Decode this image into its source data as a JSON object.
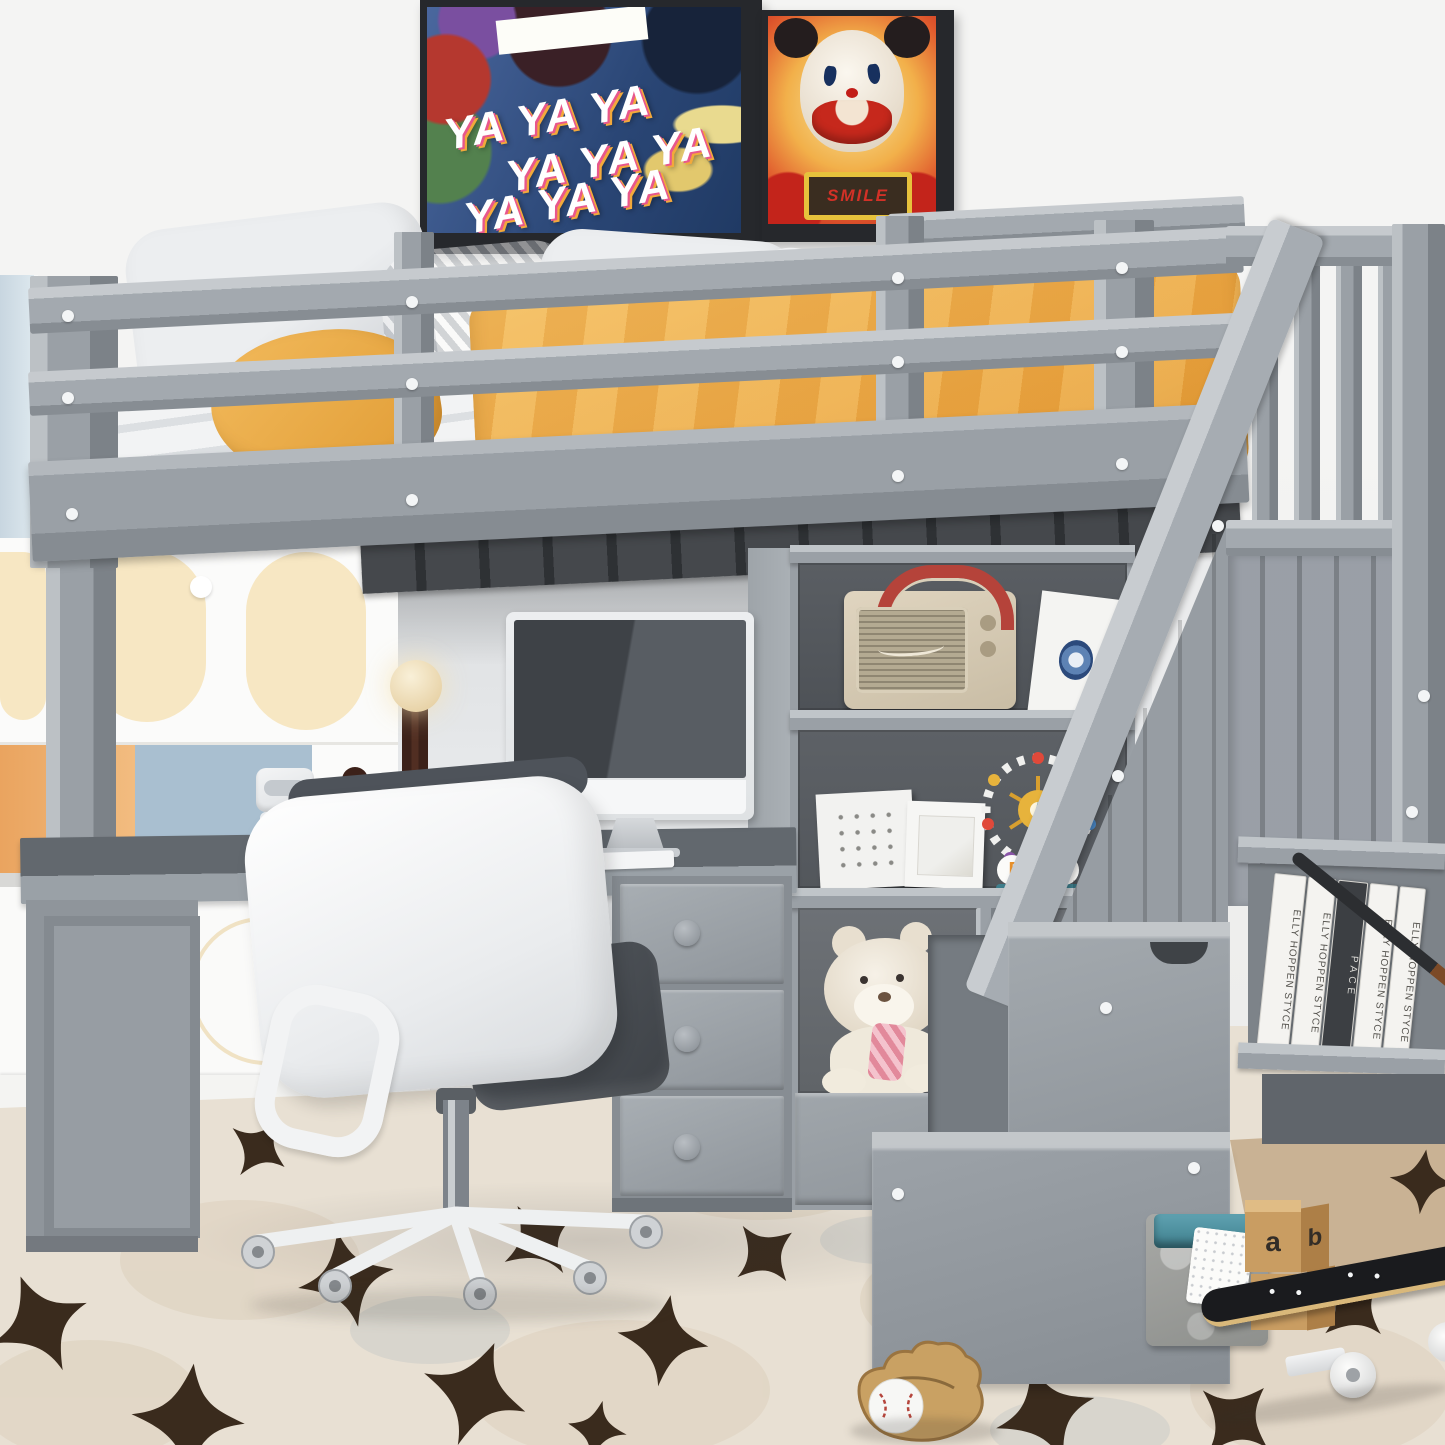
{
  "scene": {
    "name": "kids-room-gray-loft-bed-with-desk-stairs-product-photo"
  },
  "posters": {
    "ya": {
      "lines": [
        "YA YA YA",
        "YA YA YA",
        "YA YA YA"
      ]
    },
    "smile": {
      "sign": "SMILE"
    }
  },
  "lego": {
    "sign": "FUN"
  },
  "books": {
    "spines": [
      "ELLY HOPPEN STYCE",
      "ELLY HOPPEN STYCE",
      "PACE",
      "ELLY HOPPEN STYCE",
      "ELLY HOPPEN STYCE"
    ]
  },
  "blocks": {
    "faces": [
      "a",
      "b",
      "3",
      "4"
    ]
  },
  "palette": {
    "furniture_gray": "#9aa0a6",
    "furniture_gray_light": "#c3c7cb",
    "furniture_gray_dark": "#6e747a",
    "shelf_back": "#54585d",
    "blanket_yellow": "#efae45",
    "wall": "#f1f1f0",
    "rug_cream": "#e8e0d3",
    "rug_spot_brown": "#3a2b1d",
    "radio_cream": "#d7cbb5",
    "radio_strap_red": "#b5433a",
    "basket_teal": "#4d8fa0",
    "wood_tan": "#c99d62"
  }
}
